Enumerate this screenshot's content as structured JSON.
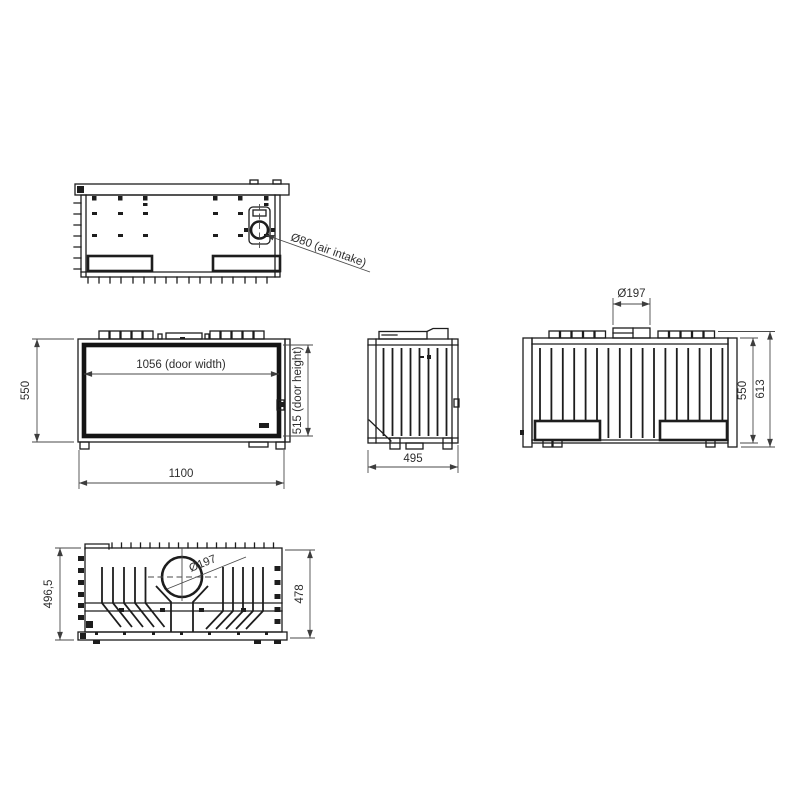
{
  "colors": {
    "background": "#ffffff",
    "line": "#1d1d1d",
    "dimension_line": "#4a4a4a",
    "text": "#2e2e2e"
  },
  "views": {
    "underside": {
      "air_intake_label": "Ø80 (air intake)"
    },
    "front": {
      "overall_height": "550",
      "door_width": "1056 (door width)",
      "door_height": "515 (door height)",
      "overall_width": "1100"
    },
    "side": {
      "depth": "495"
    },
    "rear": {
      "flue_diameter": "Ø197",
      "body_height": "550",
      "overall_height": "613"
    },
    "top": {
      "flue_diameter": "Ø197",
      "depth_with_base": "496,5",
      "depth": "478"
    }
  }
}
